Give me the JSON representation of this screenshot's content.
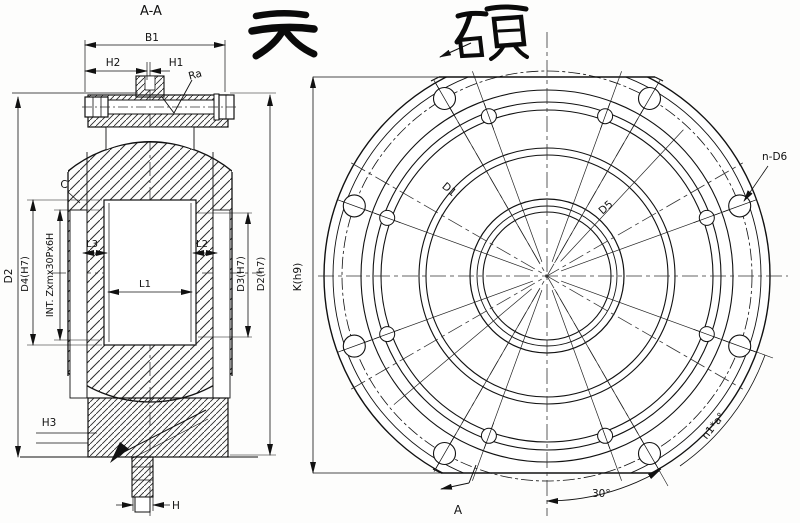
{
  "brand": {
    "calligraphy": "天硕"
  },
  "section_view": {
    "label": "A-A",
    "dims": {
      "b1": "B1",
      "h2": "H2",
      "h1": "H1",
      "ra": "Ra",
      "c": "C",
      "d2_left": "D2",
      "d4": "D4(H7)",
      "thread": "INT. Zxmx30Px6H",
      "l1": "L1",
      "l2": "L2",
      "l3": "L3",
      "d3": "D3(H7)",
      "d2_right": "D2(h7)",
      "h3": "H3",
      "h": "H"
    }
  },
  "front_view": {
    "dims": {
      "k": "K(h9)",
      "d1": "D1",
      "d5": "D5",
      "bolt_holes": "n-D6",
      "hole_spacing": "n1*a°",
      "angle_30": "30°",
      "section_arrow": "A"
    }
  }
}
